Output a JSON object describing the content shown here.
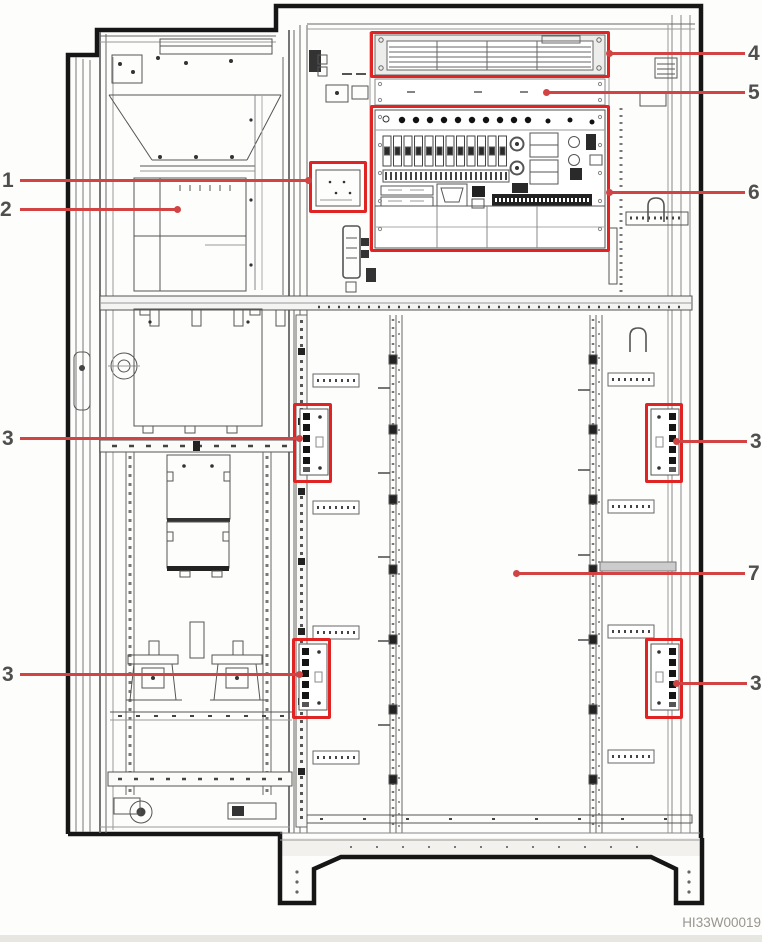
{
  "figure": {
    "code": "HI33W00019"
  },
  "colors": {
    "highlight": "#e02424",
    "leader": "#d24444",
    "label": "#4f4f4f"
  },
  "callouts": [
    {
      "label": "1"
    },
    {
      "label": "2"
    },
    {
      "label": "3"
    },
    {
      "label": "3"
    },
    {
      "label": "4"
    },
    {
      "label": "5"
    },
    {
      "label": "6"
    },
    {
      "label": "3"
    },
    {
      "label": "7"
    },
    {
      "label": "3"
    }
  ]
}
